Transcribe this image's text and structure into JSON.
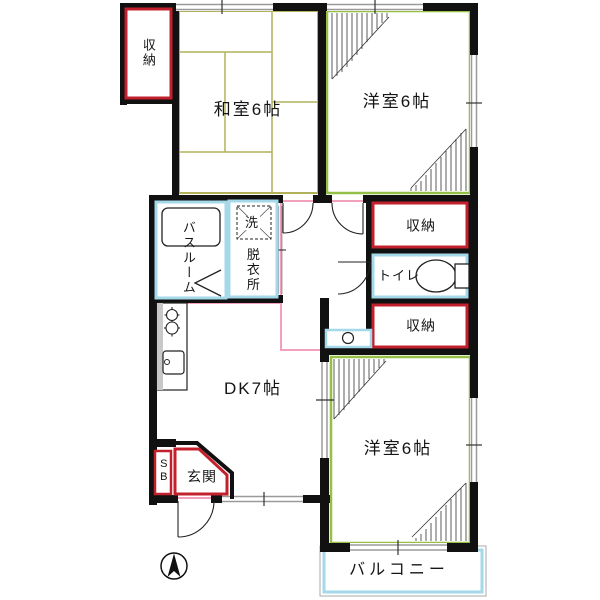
{
  "title": "apartment-floor-plan",
  "rooms": {
    "washitsu": {
      "label": "和室6帖"
    },
    "yoshitsu_top": {
      "label": "洋室6帖"
    },
    "yoshitsu_bottom": {
      "label": "洋室6帖"
    },
    "dk": {
      "label": "DK7帖"
    },
    "balcony": {
      "label": "バルコニー"
    },
    "bathroom": {
      "label": "バスルーム"
    },
    "dressing_room": {
      "label": "脱衣所"
    },
    "washer_space": {
      "label": "洗"
    },
    "toilet": {
      "label": "トイレ"
    },
    "storage_top_left": {
      "label": "収納"
    },
    "storage_right_upper": {
      "label": "収納"
    },
    "storage_right_lower": {
      "label": "収納"
    },
    "genkan": {
      "label": "玄関"
    },
    "shoe_box": {
      "label": "SB"
    }
  },
  "icons": {
    "compass": "north-arrow-icon",
    "toilet_fixture": "toilet-icon",
    "bathtub": "bathtub-icon",
    "stove": "stove-burners-icon",
    "kitchen_sink": "kitchen-sink-icon",
    "washbasin": "washbasin-icon",
    "entry_door": "door-swing-icon"
  },
  "colors": {
    "wall": "#111111",
    "tatami_line": "#b2b25a",
    "western_room_border": "#94c047",
    "storage_border": "#c3202e",
    "water_area_border": "#a5d8e8",
    "partition_pink": "#f2a0bc",
    "window_gray": "#9a9a9a"
  }
}
